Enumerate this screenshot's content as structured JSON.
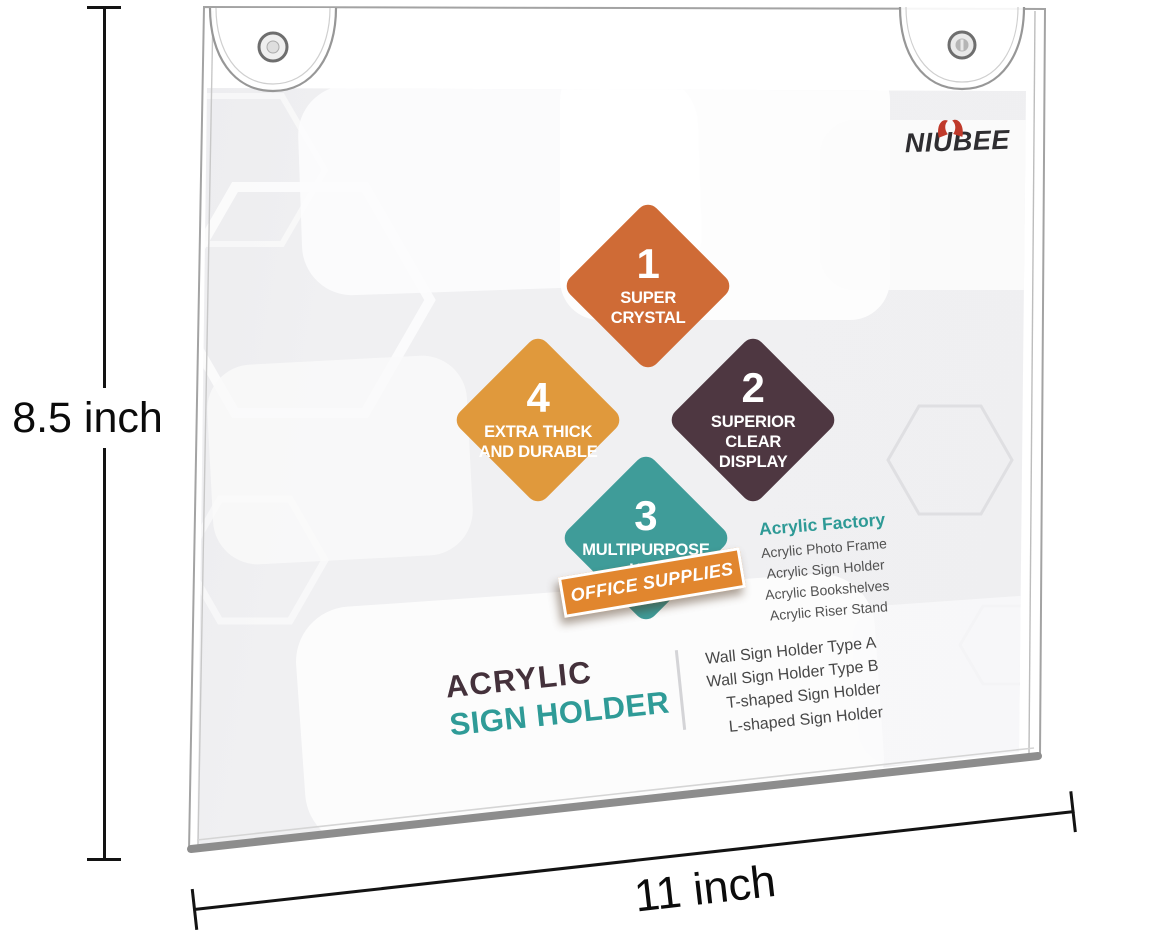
{
  "brand": {
    "name": "NIUBEE",
    "horn_color": "#c03a2b",
    "text_color": "#2f2e31"
  },
  "features": [
    {
      "number": "1",
      "lines": [
        "SUPER",
        "CRYSTAL"
      ],
      "color": "#cf6b36"
    },
    {
      "number": "2",
      "lines": [
        "SUPERIOR",
        "CLEAR DISPLAY"
      ],
      "color": "#4e3741"
    },
    {
      "number": "3",
      "lines": [
        "MULTIPURPOSE",
        "USE"
      ],
      "color": "#3f9c99"
    },
    {
      "number": "4",
      "lines": [
        "EXTRA THICK",
        "AND DURABLE"
      ],
      "color": "#e0993c"
    }
  ],
  "ribbon": {
    "label": "OFFICE SUPPLIES",
    "color": "#e1862e"
  },
  "factory": {
    "title": "Acrylic Factory",
    "title_color": "#2e9a96",
    "items": [
      "Acrylic Photo Frame",
      "Acrylic Sign Holder",
      "Acrylic Bookshelves",
      "Acrylic Riser Stand"
    ]
  },
  "product": {
    "title_line1": "ACRYLIC",
    "title_line2": "SIGN HOLDER",
    "line1_color": "#44313b",
    "line2_color": "#2f9b97"
  },
  "sign_types": [
    "Wall Sign Holder Type A",
    "Wall Sign Holder Type B",
    "T-shaped Sign Holder",
    "L-shaped Sign Holder"
  ],
  "dimensions": {
    "height_label": "8.5 inch",
    "width_label": "11 inch"
  }
}
